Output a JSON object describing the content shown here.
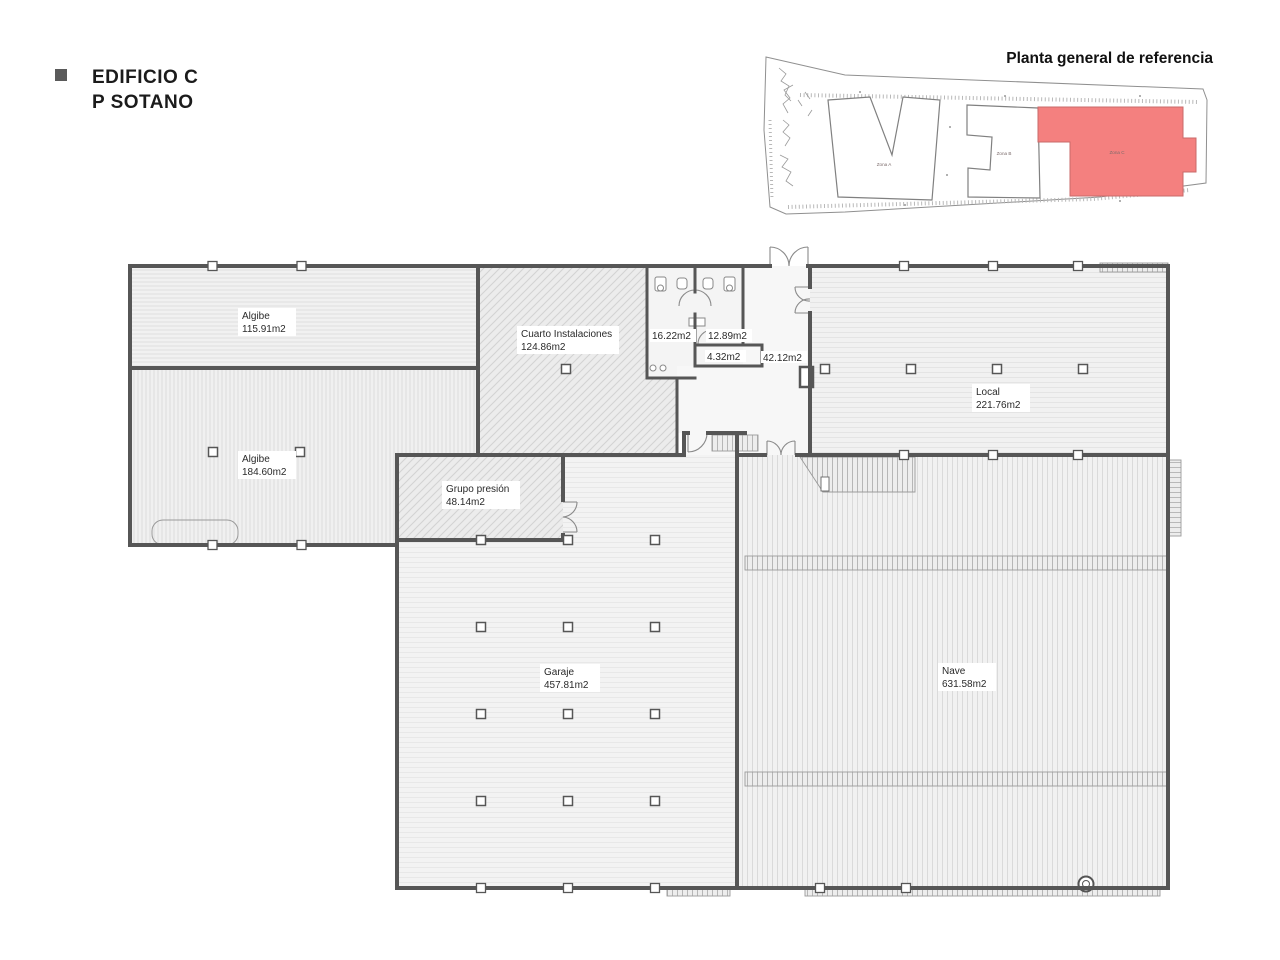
{
  "header": {
    "title_line1": "EDIFICIO C",
    "title_line2": "P SOTANO",
    "bullet_color": "#5a5a5a"
  },
  "reference_plan": {
    "title": "Planta general de referencia",
    "highlight_color": "#f4807f",
    "zones": [
      {
        "label": "Zona A",
        "highlighted": false
      },
      {
        "label": "Zona B",
        "highlighted": false
      },
      {
        "label": "Zona C",
        "highlighted": true
      }
    ]
  },
  "floor_plan": {
    "wall_color": "#565656",
    "rooms": {
      "algibe1": {
        "name": "Algibe",
        "area": "115.91m2"
      },
      "algibe2": {
        "name": "Algibe",
        "area": "184.60m2"
      },
      "cuarto": {
        "name": "Cuarto Instalaciones",
        "area": "124.86m2"
      },
      "aseo1": {
        "area": "16.22m2"
      },
      "aseo2": {
        "area": "12.89m2"
      },
      "aseo3": {
        "area": "4.32m2"
      },
      "pasillo": {
        "area": "42.12m2"
      },
      "local": {
        "name": "Local",
        "area": "221.76m2"
      },
      "grupo": {
        "name": "Grupo presión",
        "area": "48.14m2"
      },
      "garaje": {
        "name": "Garaje",
        "area": "457.81m2"
      },
      "nave": {
        "name": "Nave",
        "area": "631.58m2"
      }
    }
  }
}
